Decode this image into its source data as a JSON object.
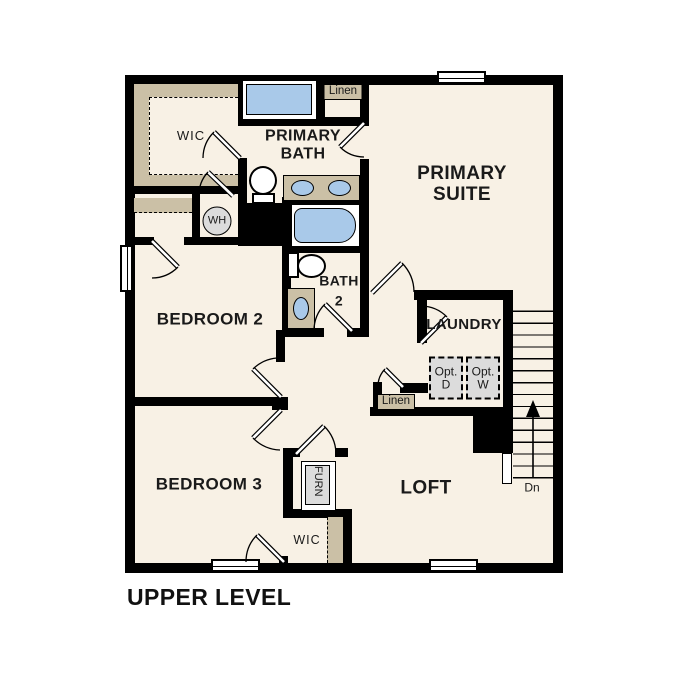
{
  "title": "UPPER LEVEL",
  "colors": {
    "background": "#ffffff",
    "floor": "#f8f1e5",
    "wall": "#000000",
    "cabinetry_tan": "#cbc0a6",
    "fixture_blue": "#a9c9e9",
    "appliance_gray": "#dcdcdc",
    "text": "#1a1a1a"
  },
  "rooms": {
    "wic_upper": {
      "label": "WIC"
    },
    "primary_bath": {
      "line1": "PRIMARY",
      "line2": "BATH"
    },
    "linen_upper": {
      "label": "Linen"
    },
    "primary_suite": {
      "line1": "PRIMARY",
      "line2": "SUITE"
    },
    "water_heater": {
      "label": "WH"
    },
    "bedroom2": {
      "label": "BEDROOM 2"
    },
    "bath2": {
      "line1": "BATH",
      "line2": "2"
    },
    "laundry": {
      "label": "LAUNDRY"
    },
    "opt_dryer": {
      "line1": "Opt.",
      "line2": "D"
    },
    "opt_washer": {
      "line1": "Opt.",
      "line2": "W"
    },
    "linen_mid": {
      "label": "Linen"
    },
    "bedroom3": {
      "label": "BEDROOM 3"
    },
    "furnace": {
      "label": "FURN"
    },
    "loft": {
      "label": "LOFT"
    },
    "wic_lower": {
      "label": "WIC"
    },
    "stairs": {
      "down_label": "Dn"
    }
  }
}
